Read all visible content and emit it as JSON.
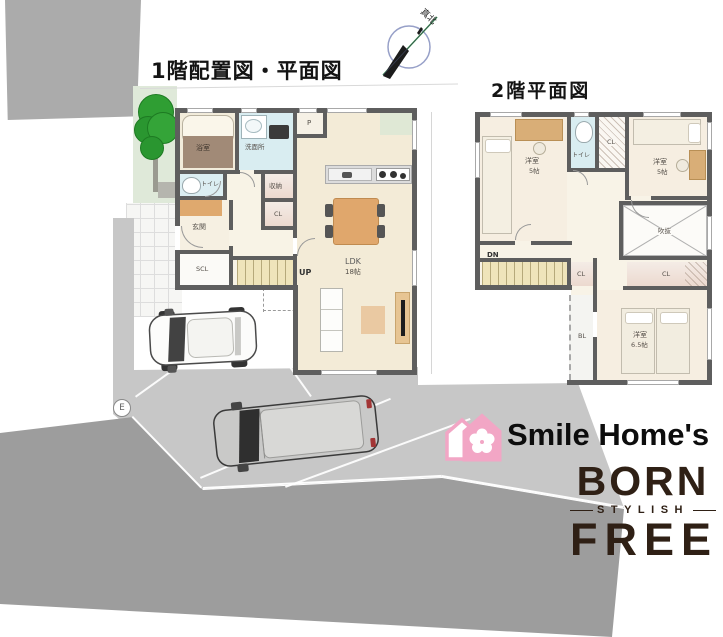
{
  "titles": {
    "floor1": "1階配置図・平面図",
    "floor2": "2階平面図"
  },
  "compass": {
    "true_north": "真北"
  },
  "site": {
    "pole": "E"
  },
  "floor1": {
    "labels": {
      "bath": "浴室",
      "washroom": "洗面所",
      "pantry": "P",
      "toilet": "トイレ",
      "storage": "収納",
      "closet": "CL",
      "entrance": "玄関",
      "shoe_closet": "SCL",
      "stairs_up": "UP",
      "ldk": "LDK",
      "ldk_size": "18帖"
    }
  },
  "floor2": {
    "labels": {
      "bedroom_left": "洋室",
      "bedroom_left_size": "5帖",
      "bedroom_right": "洋室",
      "bedroom_right_size": "5帖",
      "bedroom_main": "洋室",
      "bedroom_main_size": "6.5帖",
      "toilet": "トイレ",
      "closet_top": "CL",
      "closet_mid": "CL",
      "closet_wide": "CL",
      "void": "吹抜",
      "stairs_down": "DN",
      "balcony": "BL"
    }
  },
  "logo": {
    "brand": "Smile Home's",
    "born": "BORN",
    "stylish": "STYLISH",
    "free": "FREE"
  },
  "colors": {
    "wall": "#5e5e5e",
    "floor_cream": "#f3ebd7",
    "water_blue": "#d9edf1",
    "stairs_beige": "#efe4ba",
    "closet_pink": "#f1e2da",
    "furniture_tan": "#e0a76c",
    "driveway_gray": "#c7c7c7",
    "road_gray": "#9d9d9d",
    "garden_green": "#dfe9d9",
    "tree_green": "#2f9e33",
    "logo_pink": "#f2a6c5",
    "logo_brown": "#2f2015"
  }
}
